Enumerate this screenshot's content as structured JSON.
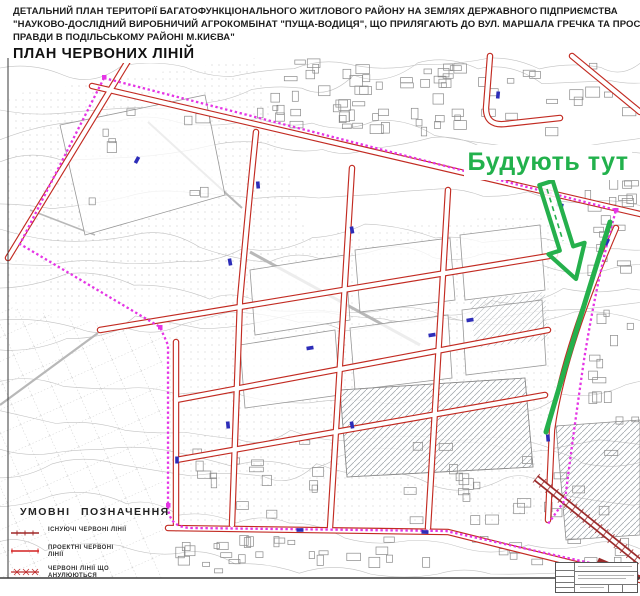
{
  "header": {
    "title_line1": "ДЕТАЛЬНИЙ ПЛАН ТЕРИТОРІЇ БАГАТОФУНКЦІОНАЛЬНОГО ЖИТЛОВОГО РАЙОНУ НА ЗЕМЛЯХ ДЕРЖАВНОГО ПІДПРИЄМСТВА",
    "title_line2": "\"НАУКОВО-ДОСЛІДНИЙ ВИРОБНИЧИЙ АГРОКОМБІНАТ \"ПУЩА-ВОДИЦЯ\", ЩО ПРИЛЯГАЮТЬ ДО ВУЛ. МАРШАЛА ГРЕЧКА ТА ПРОСП.",
    "title_line3": "ПРАВДИ В ПОДІЛЬСЬКОМУ РАЙОНІ М.КИЄВА\"",
    "subtitle": "ПЛАН ЧЕРВОНИХ ЛІНІЙ"
  },
  "annotation": {
    "label": "Будують тут",
    "color": "#22b14c"
  },
  "legend": {
    "title": "УМОВНІ  ПОЗНАЧЕННЯ",
    "items": [
      {
        "label": "ІСНУЮЧІ ЧЕРВОНІ ЛІНІЇ",
        "style": "existing-red-line"
      },
      {
        "label": "ПРОЕКТНІ ЧЕРВОНІ ЛІНІЇ",
        "style": "projected-red-line"
      },
      {
        "label": "ЧЕРВОНІ ЛІНІЇ ЩО АНУЛЮЮТЬСЯ",
        "style": "annulled-red-line"
      }
    ]
  },
  "map_colors": {
    "red_line": "#c22b22",
    "existing_red_line": "#9b2b2b",
    "boundary_magenta": "#e535e5",
    "dimension_blue": "#2d2db8",
    "annotation_green": "#22b14c",
    "topo_gray": "#c2c2c2"
  }
}
